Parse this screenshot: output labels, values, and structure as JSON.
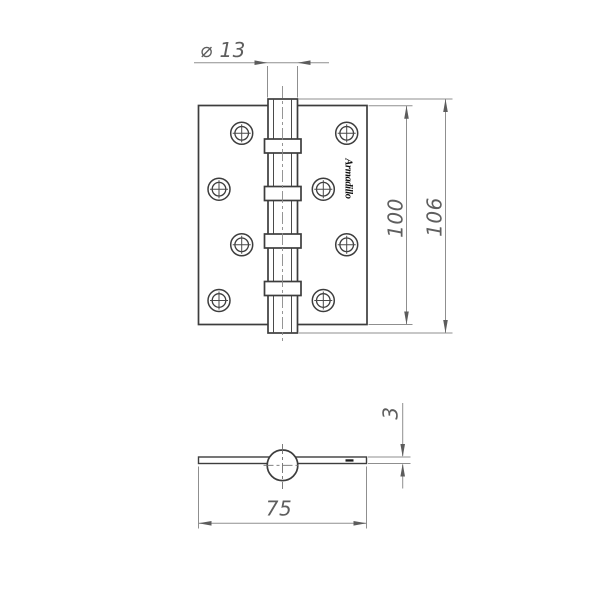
{
  "drawing": {
    "type": "hinge-technical-drawing",
    "logo_text": "Armadillo",
    "dims": {
      "barrel_diameter": "⌀ 13",
      "plate_height": "100",
      "overall_height": "106",
      "plate_width": "75",
      "plate_thickness": "3"
    },
    "colors": {
      "background": "#ffffff",
      "object_line": "#3d3d3d",
      "dimension_line": "#8f8f8f",
      "dimension_text": "#5e5e5e",
      "arrowhead": "#5c5c5c",
      "logo": "#0e0e0e"
    }
  }
}
